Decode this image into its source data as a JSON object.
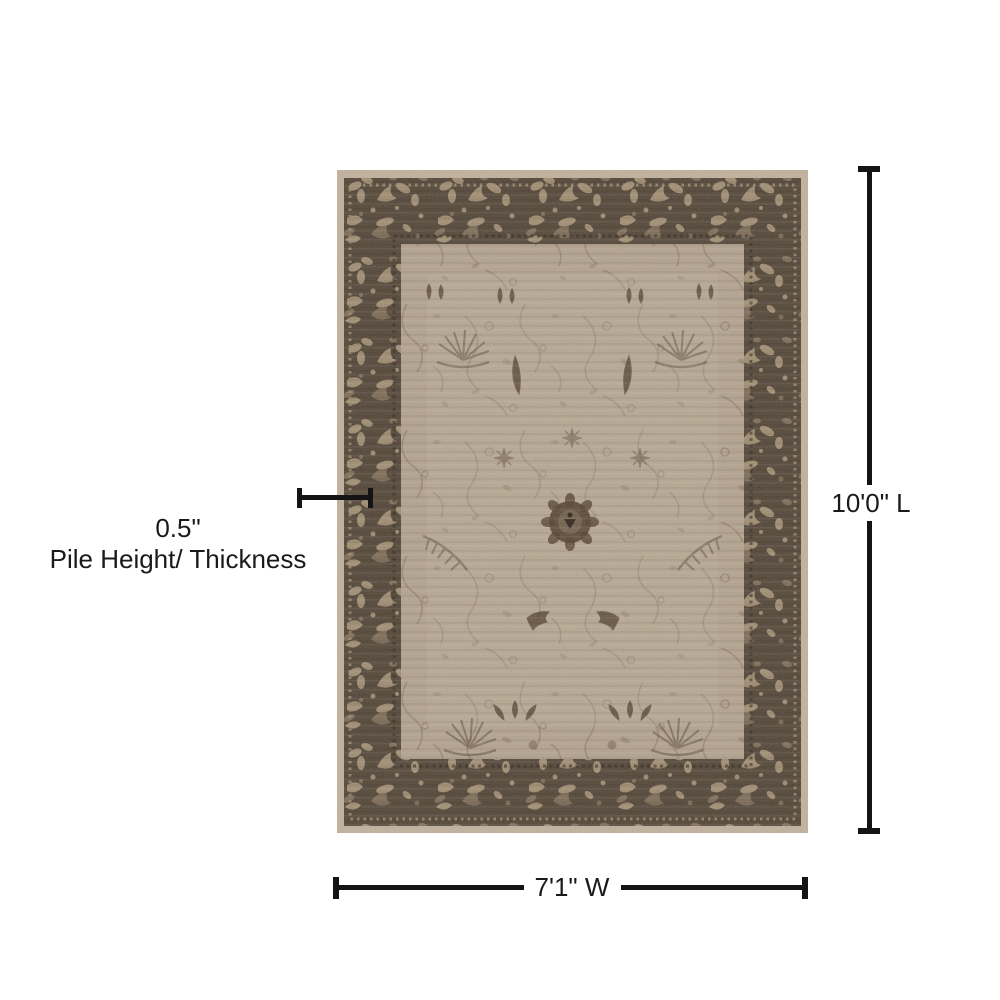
{
  "annotations": {
    "length_label": "10'0\" L",
    "width_label": "7'1\" W",
    "pile_value": "0.5\"",
    "pile_label": "Pile Height/ Thickness",
    "line_color": "#141414",
    "text_color": "#1a1a1a"
  },
  "rug": {
    "colors": {
      "outer_edge": "#c2b19c",
      "border_background": "#524536",
      "border_motif_light": "#a79377",
      "border_motif_mid": "#8a775f",
      "guard_light": "#9c886d",
      "guard_dark": "#32281c",
      "field_background": "#b3a28d",
      "field_panel": "#c2b29d",
      "field_motif": "#6f5e49",
      "field_motif_dark": "#55432f",
      "medallion_outer": "#55432f",
      "medallion_inner": "#73624c"
    }
  }
}
